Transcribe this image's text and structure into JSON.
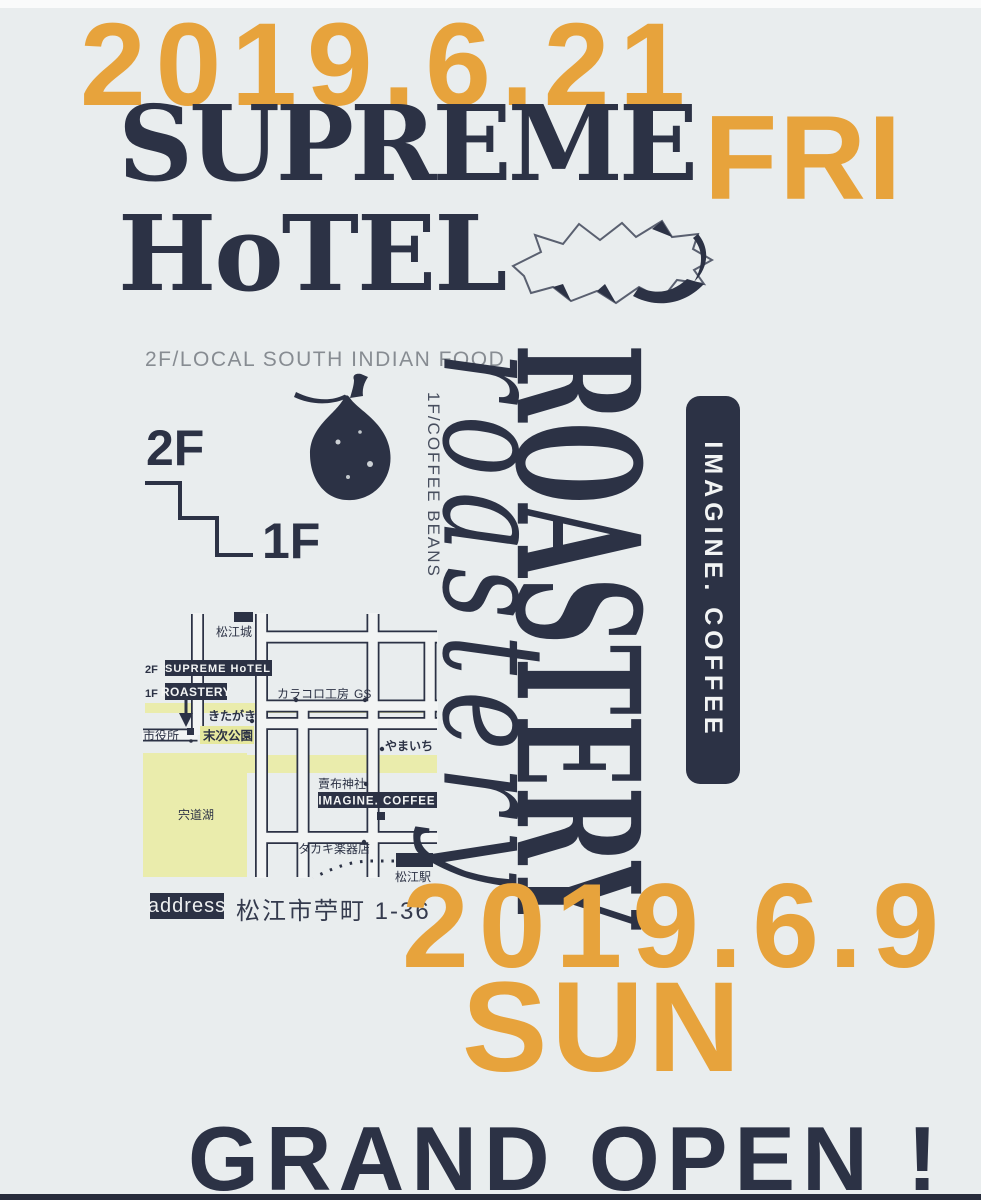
{
  "poster": {
    "top": {
      "date": "2019.6.21",
      "day": "FRI",
      "title_line1": "SUPREME",
      "title_line2": "HoTEL"
    },
    "info": {
      "caption_2f": "2F/LOCAL SOUTH INDIAN FOOD",
      "floor_upper": "2F",
      "floor_lower": "1F",
      "caption_1f": "1F/COFFEE BEANS"
    },
    "brand": {
      "roastery": "ROASTERY",
      "script": "roastery",
      "badge": "IMAGINE. COFFEE"
    },
    "map": {
      "castle": "松江城",
      "floor2": "2F",
      "hotel_box": "SUPREME HoTEL",
      "floor1": "1F",
      "roastery_box": "ROASTERY",
      "karakoro": "カラコロ工房",
      "gs": "GS",
      "kitagaki": "きたがき",
      "cityhall": "市役所",
      "park": "末次公園",
      "yamaichi": "やまいち",
      "lake": "宍道湖",
      "shrine": "賣布神社",
      "imagine": "IMAGINE. COFFEE",
      "takaki": "タカキ楽器店",
      "station": "松江駅"
    },
    "address": {
      "label": "address",
      "value": "松江市苧町 1-36"
    },
    "bottom": {
      "date": "2019.6.9",
      "day": "SUN",
      "open": "GRAND OPEN !"
    },
    "colors": {
      "orange": "#E7A33C",
      "navy": "#2C3245",
      "background": "#E9EDEE",
      "map_yellow": "#EAECAC",
      "gray_caption": "#878C92"
    }
  }
}
